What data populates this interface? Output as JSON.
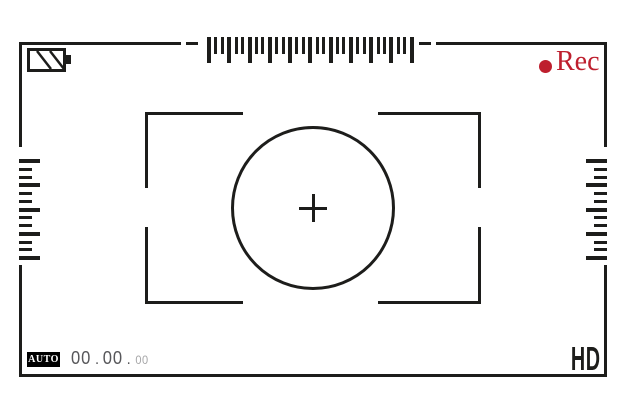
{
  "viewfinder": {
    "colors": {
      "background": "#ffffff",
      "line": "#1d1d1b",
      "record_red": "#be1f2e",
      "timecode_main": "#57575a",
      "timecode_small": "#a6a6a8",
      "badge_bg": "#000000",
      "badge_text": "#ffffff"
    },
    "status_bar": {
      "battery_icon": "battery-partial-diagonal-stripes",
      "record_icon": "record-dot",
      "rec_label": "Rec"
    },
    "rulers": {
      "top": {
        "ticks": 31,
        "major_every": 3
      },
      "left": {
        "ticks": 13,
        "major_every": 3
      },
      "right": {
        "ticks": 13,
        "major_every": 3
      }
    },
    "focus": {
      "center_icon": "crosshair-plus",
      "shape": "focus-circle-with-brackets"
    },
    "bottom_bar": {
      "mode_label": "AUTO",
      "timecode": {
        "h": "00",
        "m": "00",
        "s": "00",
        "sep": "."
      },
      "quality_label": "HD"
    }
  }
}
